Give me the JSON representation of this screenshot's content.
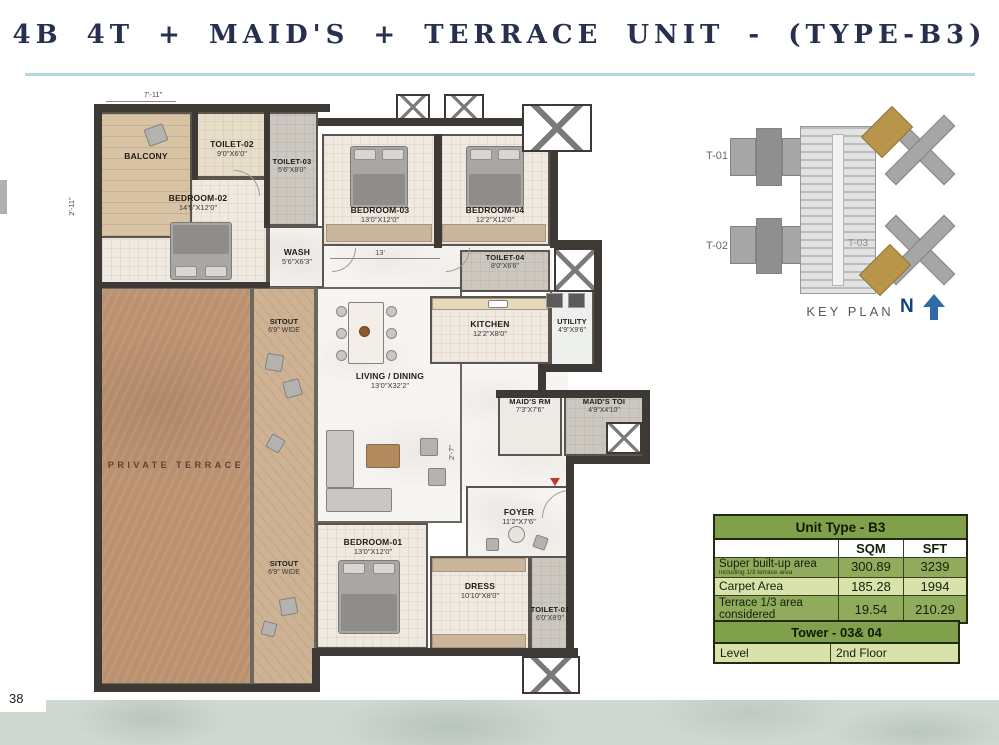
{
  "title": "4B 4T + MAID'S + TERRACE UNIT - (TYPE-B3)",
  "page_number": "38",
  "floor_plan": {
    "dim_top": "7'-11\"",
    "dim_left": "2'-11\"",
    "dim_hall": "13'",
    "dim_foyer": "2'-7\"",
    "rooms": {
      "balcony": {
        "name": "BALCONY",
        "dim": ""
      },
      "toilet02": {
        "name": "TOILET-02",
        "dim": "9'0\"X6'0\""
      },
      "toilet03": {
        "name": "TOILET-03",
        "dim": "5'6\"X8'0\""
      },
      "bedroom02": {
        "name": "BEDROOM-02",
        "dim": "14'5\"X12'0\""
      },
      "wash": {
        "name": "WASH",
        "dim": "5'6\"X6'3\""
      },
      "bedroom03": {
        "name": "BEDROOM-03",
        "dim": "13'0\"X12'0\""
      },
      "bedroom04": {
        "name": "BEDROOM-04",
        "dim": "12'2\"X12'0\""
      },
      "toilet04": {
        "name": "TOILET-04",
        "dim": "8'0\"X6'6\""
      },
      "kitchen": {
        "name": "KITCHEN",
        "dim": "12'2\"X8'0\""
      },
      "utility": {
        "name": "UTILITY",
        "dim": "4'9\"X9'6\""
      },
      "living": {
        "name": "LIVING / DINING",
        "dim": "13'0\"X32'2\""
      },
      "maids_rm": {
        "name": "MAID'S RM",
        "dim": "7'3\"X7'6\""
      },
      "maids_toi": {
        "name": "MAID'S TOI",
        "dim": "4'9\"X4'10\""
      },
      "foyer": {
        "name": "FOYER",
        "dim": "11'2\"X7'6\""
      },
      "bedroom01": {
        "name": "BEDROOM-01",
        "dim": "13'0\"X12'0\""
      },
      "dress": {
        "name": "DRESS",
        "dim": "10'10\"X8'0\""
      },
      "toilet01": {
        "name": "TOILET-01",
        "dim": "6'0\"X8'0\""
      },
      "private_terrace": {
        "name": "PRIVATE TERRACE",
        "dim": ""
      },
      "sitout_upper": {
        "name": "SITOUT",
        "dim": "6'9\" WIDE"
      },
      "sitout_lower": {
        "name": "SITOUT",
        "dim": "6'9\" WIDE"
      }
    }
  },
  "key_plan": {
    "label": "KEY PLAN",
    "tower1": "T-01",
    "tower2": "T-02",
    "tower3": "T-03",
    "north": "N"
  },
  "area_table": {
    "title": "Unit Type - B3",
    "col_sqm": "SQM",
    "col_sft": "SFT",
    "rows": [
      {
        "label": "Super built-up area",
        "sublabel": "including 1/3 terrace area",
        "sqm": "300.89",
        "sft": "3239"
      },
      {
        "label": "Carpet Area",
        "sublabel": "",
        "sqm": "185.28",
        "sft": "1994"
      },
      {
        "label": "Terrace 1/3 area considered",
        "sublabel": "",
        "sqm": "19.54",
        "sft": "210.29"
      }
    ]
  },
  "tower_table": {
    "title": "Tower - 03& 04",
    "level_label": "Level",
    "level_value": "2nd Floor"
  },
  "colors": {
    "accent_green": "#81a04c",
    "row_olive": "#8fab5b",
    "row_light": "#d9e2ab",
    "title_navy": "#27304f",
    "north_blue": "#2f6ba8",
    "terrace_brown": "#bb9170"
  }
}
